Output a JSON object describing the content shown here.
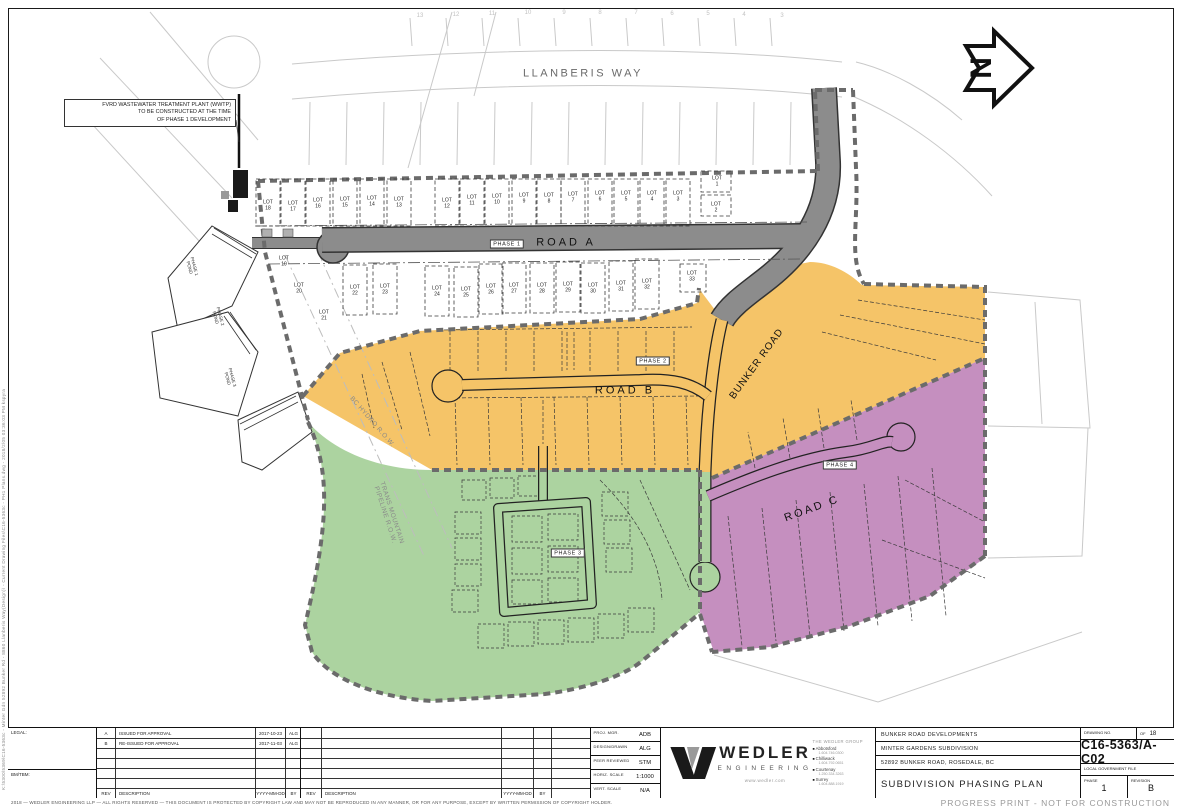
{
  "sheet": {
    "file_path_note": "K:\\5300\\5369\\C16-5363c - Minter Gdn 52892 Bunker Rd - 8860 Llanberis Way(Design)\\ - Current Drawing Files\\C16-5363c - PH1 Plans.dwg - 2018/2/05  03:36:03 PM  kspyra",
    "copyright": "2018  —  WEDLER ENGINEERING LLP  —  ALL RIGHTS RESERVED  —  THIS DOCUMENT IS PROTECTED BY COPYRIGHT LAW AND MAY NOT BE REPRODUCED IN ANY MANNER, OR FOR ANY PURPOSE, EXCEPT BY WRITTEN PERMISSION OF COPYRIGHT HOLDER.",
    "progress_note": "PROGRESS PRINT - NOT FOR CONSTRUCTION"
  },
  "colors": {
    "phase1_road": "#8C8C8C",
    "phase2": "#F5C468",
    "phase3": "#ACD3A0",
    "phase4": "#C58FBF",
    "boundary_dash": "#6b6b6b"
  },
  "map": {
    "north_label": "N",
    "wwtp_note": {
      "l1": "FVRD WASTEWATER TREATMENT PLANT (WWTP)",
      "l2": "TO BE CONSTRUCTED AT THE TIME",
      "l3": "OF PHASE 1 DEVELOPMENT"
    },
    "street_labels": [
      {
        "t": "LLANBERIS WAY",
        "x": 583,
        "y": 74,
        "s": 11,
        "ls": 2.5,
        "c": "#6a6a6a"
      },
      {
        "t": "ROAD A",
        "x": 566,
        "y": 243,
        "s": 11,
        "ls": 3,
        "c": "#111111"
      },
      {
        "t": "ROAD B",
        "x": 625,
        "y": 391,
        "s": 11,
        "ls": 3,
        "c": "#111111"
      },
      {
        "t": "ROAD C",
        "x": 812,
        "y": 509,
        "s": 11,
        "ls": 2.5,
        "r": -20,
        "c": "#111111"
      },
      {
        "t": "BUNKER ROAD",
        "x": 757,
        "y": 364,
        "s": 10,
        "ls": 1,
        "r": -54,
        "c": "#111111"
      },
      {
        "t": "BC HYDRO R.O.W.",
        "x": 372,
        "y": 422,
        "s": 6.5,
        "ls": 0.5,
        "r": 49,
        "c": "#8a8a8a"
      },
      {
        "t": "TRANS MOUNTAIN",
        "t2": "PIPELINE R.O.W.",
        "x": 388,
        "y": 514,
        "s": 6.5,
        "ls": 0.5,
        "r": 72,
        "c": "#8a8a8a"
      }
    ],
    "phase_tags": [
      {
        "t": "PHASE 1",
        "x": 507,
        "y": 244
      },
      {
        "t": "PHASE 2",
        "x": 653,
        "y": 361
      },
      {
        "t": "PHASE 3",
        "x": 568,
        "y": 553
      },
      {
        "t": "PHASE 4",
        "x": 840,
        "y": 465
      }
    ],
    "lot_word": "LOT",
    "lots_above": [
      {
        "n": "18",
        "x": 268,
        "y": 206
      },
      {
        "n": "17",
        "x": 293,
        "y": 207
      },
      {
        "n": "16",
        "x": 318,
        "y": 204
      },
      {
        "n": "15",
        "x": 345,
        "y": 203
      },
      {
        "n": "14",
        "x": 372,
        "y": 202
      },
      {
        "n": "13",
        "x": 399,
        "y": 203
      },
      {
        "n": "12",
        "x": 447,
        "y": 204
      },
      {
        "n": "11",
        "x": 472,
        "y": 201
      },
      {
        "n": "10",
        "x": 497,
        "y": 200
      },
      {
        "n": "9",
        "x": 524,
        "y": 199
      },
      {
        "n": "8",
        "x": 549,
        "y": 199
      },
      {
        "n": "7",
        "x": 573,
        "y": 198
      },
      {
        "n": "6",
        "x": 600,
        "y": 197
      },
      {
        "n": "5",
        "x": 626,
        "y": 197
      },
      {
        "n": "4",
        "x": 652,
        "y": 197
      },
      {
        "n": "3",
        "x": 678,
        "y": 197
      },
      {
        "n": "1",
        "x": 717,
        "y": 182,
        "nb": true
      },
      {
        "n": "2",
        "x": 716,
        "y": 208,
        "nb": true
      }
    ],
    "lots_below": [
      {
        "n": "19",
        "x": 284,
        "y": 262,
        "nb": true
      },
      {
        "n": "20",
        "x": 299,
        "y": 289,
        "nb": true
      },
      {
        "n": "21",
        "x": 324,
        "y": 316,
        "nb": true
      },
      {
        "n": "22",
        "x": 355,
        "y": 291
      },
      {
        "n": "23",
        "x": 385,
        "y": 290
      },
      {
        "n": "24",
        "x": 437,
        "y": 292
      },
      {
        "n": "25",
        "x": 466,
        "y": 293
      },
      {
        "n": "26",
        "x": 491,
        "y": 290
      },
      {
        "n": "27",
        "x": 514,
        "y": 289
      },
      {
        "n": "28",
        "x": 542,
        "y": 289
      },
      {
        "n": "29",
        "x": 568,
        "y": 288
      },
      {
        "n": "30",
        "x": 593,
        "y": 289
      },
      {
        "n": "31",
        "x": 621,
        "y": 287
      },
      {
        "n": "32",
        "x": 647,
        "y": 285
      },
      {
        "n": "33",
        "x": 692,
        "y": 277,
        "nb": true
      }
    ],
    "far_lots": [
      {
        "n": "13",
        "x": 420,
        "y": 16
      },
      {
        "n": "12",
        "x": 456,
        "y": 15
      },
      {
        "n": "11",
        "x": 492,
        "y": 14
      },
      {
        "n": "10",
        "x": 528,
        "y": 13
      },
      {
        "n": "9",
        "x": 564,
        "y": 13
      },
      {
        "n": "8",
        "x": 600,
        "y": 13
      },
      {
        "n": "7",
        "x": 636,
        "y": 13
      },
      {
        "n": "6",
        "x": 672,
        "y": 14
      },
      {
        "n": "5",
        "x": 708,
        "y": 14
      },
      {
        "n": "4",
        "x": 744,
        "y": 15
      },
      {
        "n": "3",
        "x": 782,
        "y": 16
      }
    ],
    "pond_labels": [
      {
        "l1": "PHASE 1",
        "l2": "POND",
        "x": 192,
        "y": 267,
        "r": 75
      },
      {
        "l1": "PHASE 2",
        "l2": "POND",
        "x": 218,
        "y": 317,
        "r": 75
      },
      {
        "l1": "PHASE 3",
        "l2": "POND",
        "x": 230,
        "y": 378,
        "r": 75
      }
    ]
  },
  "titleblock": {
    "legal_label": "LEGAL:",
    "bm_label": "BM/TBM:",
    "rev_headers": {
      "rev": "REV",
      "desc": "DESCRIPTION",
      "date": "YYYY-MM-DD",
      "by": "BY"
    },
    "revisions": [
      {
        "rev": "A",
        "desc": "ISSUED FOR APPROVAL",
        "date": "2017-10-23",
        "by": "ALG"
      },
      {
        "rev": "B",
        "desc": "RE-ISSUED FOR APPROVAL",
        "date": "2017-11-03",
        "by": "ALG"
      }
    ],
    "staff": [
      {
        "label": "PROJ. MGR.",
        "value": "ADB"
      },
      {
        "label": "DESIGN/DRAWN",
        "value": "ALG"
      },
      {
        "label": "PEER REVIEWED",
        "value": "STM"
      },
      {
        "label": "HORIZ. SCALE",
        "value": "1:1000"
      },
      {
        "label": "VERT. SCALE",
        "value": "N/A"
      }
    ],
    "brand": {
      "name": "WEDLER",
      "sub": "ENGINEERING",
      "url": "www.wedler.com",
      "group": "THE WEDLER GROUP",
      "offices": [
        {
          "name": "Abbotsford",
          "phone": "1.604.746.0300"
        },
        {
          "name": "Chilliwack",
          "phone": "1.604.792.0651"
        },
        {
          "name": "Courtenay",
          "phone": "1.250.334.3263"
        },
        {
          "name": "Surrey",
          "phone": "1.604.888.1919"
        }
      ]
    },
    "project": {
      "client": "BUNKER ROAD DEVELOPMENTS",
      "subdivision": "MINTER GARDENS SUBDIVISION",
      "address": "52892 BUNKER ROAD, ROSEDALE, BC",
      "title": "SUBDIVISION PHASING PLAN"
    },
    "drawing": {
      "label": "DRAWING NO.",
      "of": "OF",
      "sheets": "18",
      "number": "C16-5363/A-C02",
      "lgf": "LOCAL GOVERNMENT FILE",
      "phase_label": "PHASE",
      "phase": "1",
      "rev_label": "REVISION",
      "rev": "B"
    }
  }
}
